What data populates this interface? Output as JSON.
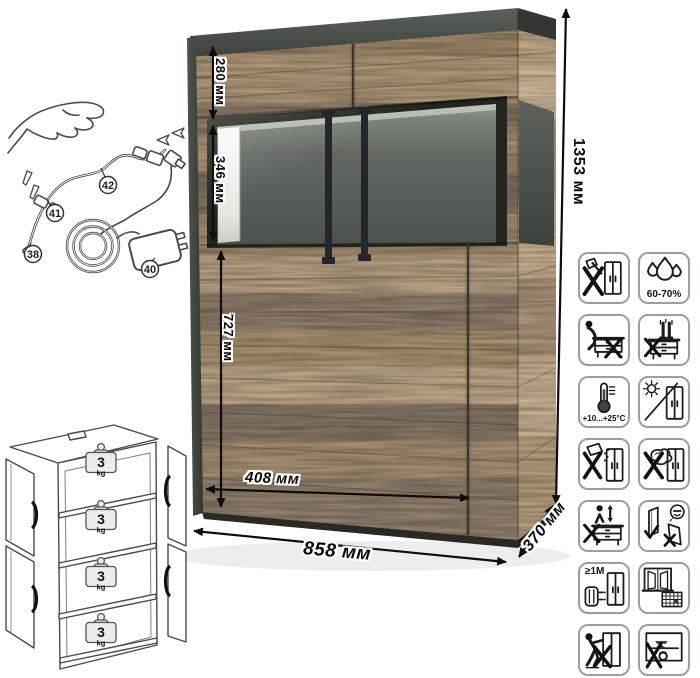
{
  "product_view": {
    "description": "wood display cabinet with glass showcase section",
    "colors": {
      "wood_light": "#b39a7c",
      "wood_dark": "#8c7c69",
      "graphite_trim": "#4b4f48",
      "glass_interior": "#565c57",
      "handle": "#23262a",
      "icon_border": "#9aa0a0",
      "dimension_text": "#0a0a0a"
    }
  },
  "dimensions": {
    "height": "1353 мм",
    "width": "858 мм",
    "depth": "370 мм",
    "top_section_height": "280 мм",
    "glass_section_height": "346 мм",
    "bottom_section_height": "727 мм",
    "door_width": "408 мм"
  },
  "wiring_diagram": {
    "callouts": {
      "power_cable": "38",
      "adapter": "40",
      "connector": "41",
      "led_cable": "42"
    }
  },
  "load_diagram": {
    "shelves": [
      {
        "value": "3",
        "unit": "kg"
      },
      {
        "value": "3",
        "unit": "kg"
      },
      {
        "value": "3",
        "unit": "kg"
      },
      {
        "value": "3",
        "unit": "kg"
      }
    ]
  },
  "care_icons": [
    {
      "name": "no-sharp-tools",
      "label": ""
    },
    {
      "name": "humidity-range",
      "label": "60-70%"
    },
    {
      "name": "no-sitting",
      "label": ""
    },
    {
      "name": "no-standing",
      "label": ""
    },
    {
      "name": "temperature-range",
      "label": "+10...+25°C"
    },
    {
      "name": "no-direct-sunlight",
      "label": ""
    },
    {
      "name": "no-spilling",
      "label": ""
    },
    {
      "name": "no-abrasive-cleaning",
      "label": ""
    },
    {
      "name": "no-climbing",
      "label": ""
    },
    {
      "name": "store-panels-upright",
      "label": ""
    },
    {
      "name": "keep-1m-from-heat",
      "label": "≥1M"
    },
    {
      "name": "ventilate-room",
      "label": ""
    },
    {
      "name": "no-dragging",
      "label": ""
    },
    {
      "name": "no-heavy-objects",
      "label": ""
    }
  ]
}
